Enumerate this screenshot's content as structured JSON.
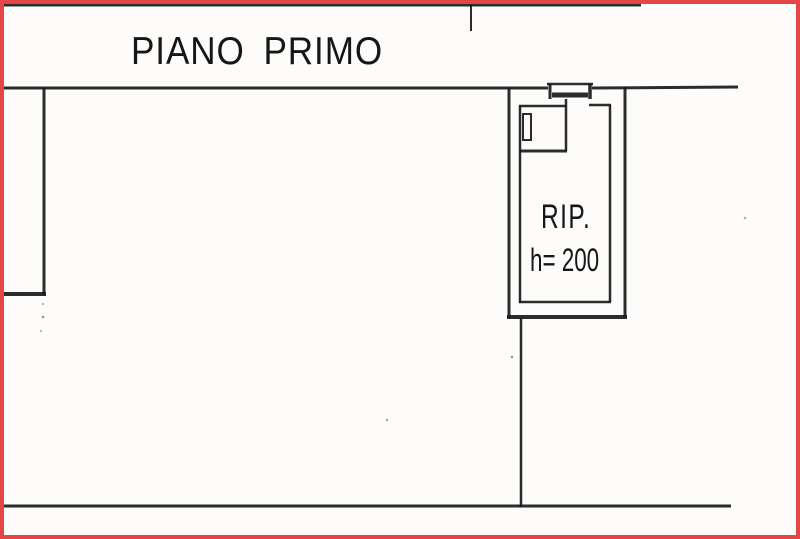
{
  "page": {
    "border_color": "#e24646",
    "background_color": "#fdfcfa",
    "ink_color": "#1a1a1a",
    "text_color": "#161616"
  },
  "plan": {
    "floor_title": "PIANO PRIMO",
    "room": {
      "label": "RIP.",
      "height_note": "h= 200"
    }
  }
}
